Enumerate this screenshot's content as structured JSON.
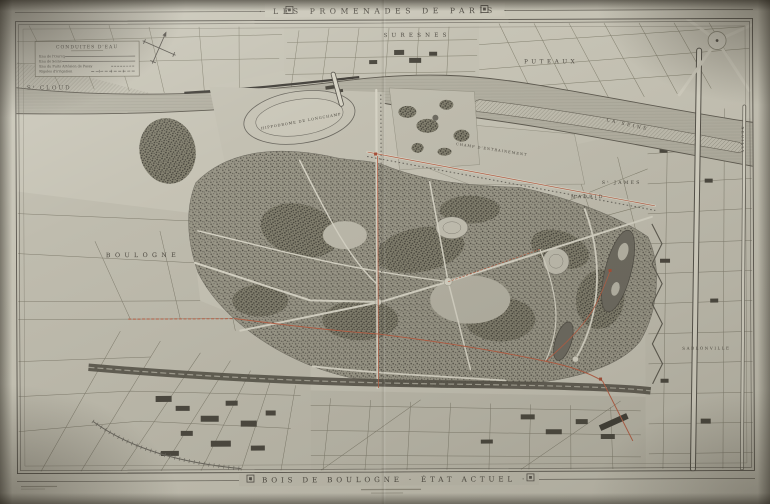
{
  "titles": {
    "top": "· LES PROMENADES DE PARIS ·",
    "bottom": "· BOIS DE BOULOGNE · ÉTAT ACTUEL ·"
  },
  "legend": {
    "title": "CONDUITES D'EAU",
    "items": [
      {
        "label": "Eau de l'Ourcq",
        "line_style": "solid"
      },
      {
        "label": "Eau de Seine",
        "line_style": "solid"
      },
      {
        "label": "Eau du Puits Artésien de Passy",
        "line_style": "dashed"
      },
      {
        "label": "Rigoles d'irrigation",
        "line_style": "dash-dot"
      }
    ]
  },
  "places": {
    "st_cloud": "Sᵗ CLOUD",
    "suresnes": "SURESNES",
    "puteaux": "PUTEAUX",
    "boulogne": "BOULOGNE",
    "madrid": "MADRID",
    "st_james": "Sᵗ JAMES",
    "sablonville": "SABLONVILLE",
    "neuilly": "NEUILLY",
    "seine": "LA SEINE",
    "hippodrome": "HIPPODROME DE LONGCHAMP",
    "champ_entrainement": "CHAMP D'ENTRAINEMENT"
  },
  "colors": {
    "paper": "#c6c3b5",
    "ink": "#55514a",
    "woods_stipple": "#55524a",
    "water_gray": "#b3b0a2",
    "conduit_red": "#b65f45"
  }
}
